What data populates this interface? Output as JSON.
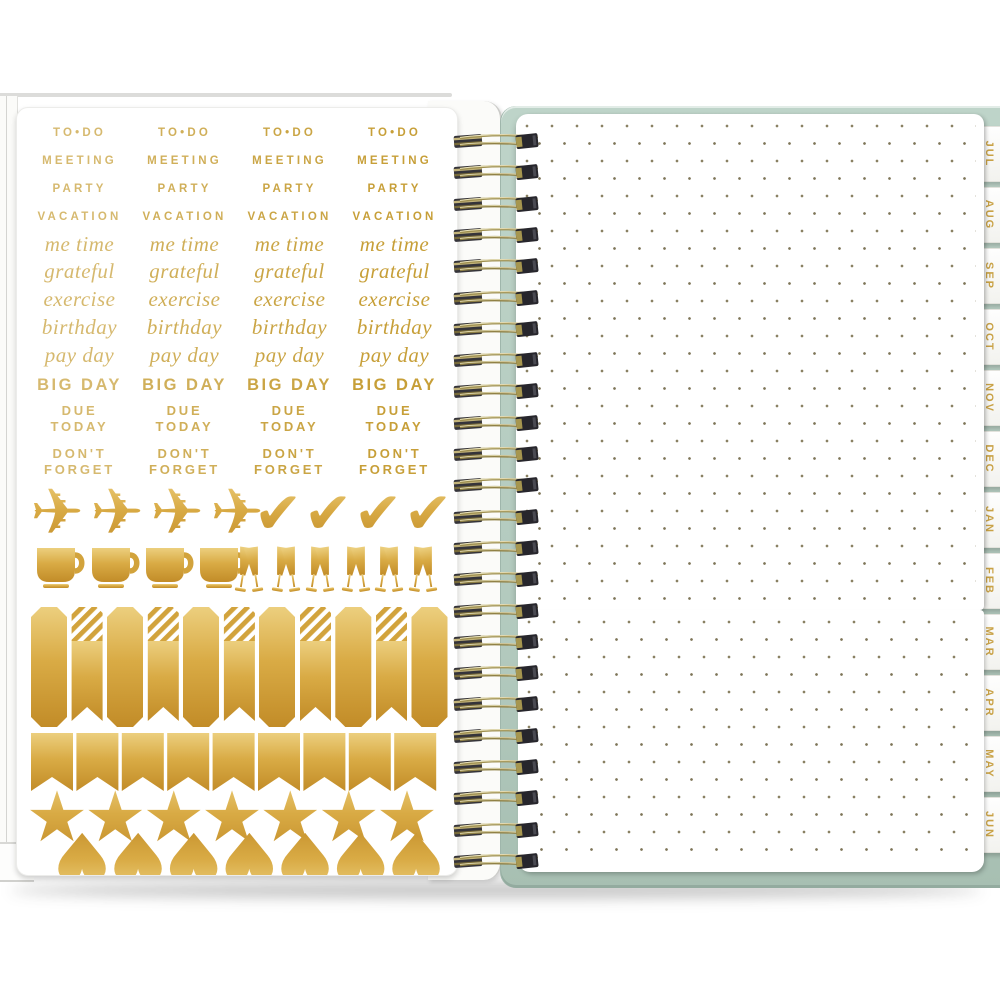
{
  "product": {
    "type": "open spiral planner spread",
    "left_page": "gold foil planner sticker sheet",
    "right_page": "dot-grid pages with monthly edge tabs",
    "binding": "gold twin-loop wire spiral",
    "cover_color_name": "mint"
  },
  "colors": {
    "gold_light": "#eccf7e",
    "gold": "#d2a33c",
    "gold_dark": "#c28c28",
    "word_gold": "#c79f38",
    "mint_cover": "#b7cec3",
    "mint_edge": "#93ab9f",
    "dot_grid": "#7d7558",
    "page_white": "#ffffff",
    "wire_gold": "#9f9051",
    "wire_clamp": "#2c2b31",
    "tab_text_gold": "#c9a246"
  },
  "sticker_sheet": {
    "columns": 4,
    "word_rows": [
      {
        "id": "to-do",
        "text": "TO•DO",
        "style": "caps"
      },
      {
        "id": "meeting",
        "text": "MEETING",
        "style": "caps"
      },
      {
        "id": "party",
        "text": "PARTY",
        "style": "caps"
      },
      {
        "id": "vacation",
        "text": "VACATION",
        "style": "caps strong"
      },
      {
        "id": "me-time",
        "text": "me time",
        "style": "script"
      },
      {
        "id": "grateful",
        "text": "grateful",
        "style": "script"
      },
      {
        "id": "exercise",
        "text": "exercise",
        "style": "script"
      },
      {
        "id": "birthday",
        "text": "birthday",
        "style": "script"
      },
      {
        "id": "pay-day",
        "text": "pay day",
        "style": "script"
      },
      {
        "id": "big-day",
        "text": "BIG DAY",
        "style": "big"
      },
      {
        "id": "due-today",
        "lines": [
          "DUE",
          "TODAY"
        ],
        "style": "two"
      },
      {
        "id": "dont-forget",
        "lines": [
          "DON'T",
          "FORGET"
        ],
        "style": "two"
      }
    ],
    "icon_rows": [
      {
        "name": "airplane",
        "count": 4,
        "glyph": "✈"
      },
      {
        "name": "checkmark",
        "count": 4,
        "glyph": "✔"
      },
      {
        "name": "coffee-cup",
        "count": 4
      },
      {
        "name": "champagne-toast",
        "count": 6
      },
      {
        "name": "banner-solid",
        "count": 6
      },
      {
        "name": "banner-striped",
        "count": 5
      },
      {
        "name": "pennant-flag",
        "count": 9
      },
      {
        "name": "star",
        "count": 7,
        "glyph": "★"
      },
      {
        "name": "heart-inverted",
        "count": 7,
        "glyph": "♥"
      }
    ]
  },
  "right_page": {
    "tabs": [
      "JUL",
      "AUG",
      "SEP",
      "OCT",
      "NOV",
      "DEC",
      "JAN",
      "FEB",
      "MAR",
      "APR",
      "MAY",
      "JUN"
    ]
  },
  "spiral": {
    "coil_count": 24
  }
}
